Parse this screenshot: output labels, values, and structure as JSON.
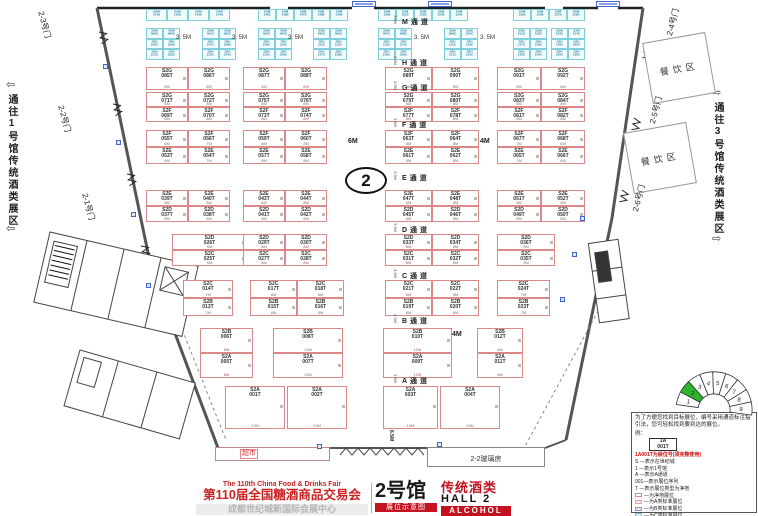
{
  "hall_number": "2",
  "side_labels": {
    "left": "通往1号馆传统酒类展区",
    "right": "通往3号馆传统酒类展区",
    "left_arrow": "⇦",
    "right_arrow": "⇨"
  },
  "areas": {
    "dining1": "餐饮区",
    "dining2": "餐饮区",
    "supermarket": "超市",
    "glasshouse": "2-2玻璃房"
  },
  "gates": [
    {
      "label": "2-3号门",
      "x": 46,
      "y": 10,
      "rot": 75
    },
    {
      "label": "2-2号门",
      "x": 66,
      "y": 104,
      "rot": 75
    },
    {
      "label": "2-1号门",
      "x": 90,
      "y": 192,
      "rot": 75
    },
    {
      "label": "2-4号门",
      "x": 664,
      "y": 34,
      "rot": -75
    },
    {
      "label": "2-5号门",
      "x": 647,
      "y": 122,
      "rot": -75
    },
    {
      "label": "2-6号门",
      "x": 630,
      "y": 210,
      "rot": -75
    }
  ],
  "aisles": {
    "width_marker": "3.5M",
    "items": [
      {
        "label": "M通道",
        "y": 17
      },
      {
        "label": "H通道",
        "y": 58
      },
      {
        "label": "G通道",
        "y": 83
      },
      {
        "label": "F通道",
        "y": 120
      },
      {
        "label": "E通道",
        "y": 173
      },
      {
        "label": "D通道",
        "y": 225
      },
      {
        "label": "C通道",
        "y": 271
      },
      {
        "label": "B通道",
        "y": 316
      },
      {
        "label": "A通道",
        "y": 376
      }
    ]
  },
  "gap_labels": {
    "text": "3. 5M",
    "positions": [
      [
        176,
        35
      ],
      [
        232,
        35
      ],
      [
        288,
        35
      ],
      [
        414,
        35
      ],
      [
        480,
        35
      ]
    ]
  },
  "misc_labels": [
    {
      "text": "6M",
      "x": 348,
      "y": 138,
      "rot": 0
    },
    {
      "text": "4M",
      "x": 480,
      "y": 138,
      "rot": 0
    },
    {
      "text": "4M",
      "x": 452,
      "y": 331,
      "rot": 0
    },
    {
      "text": "6.5M",
      "x": 394,
      "y": 430,
      "rot": 90
    }
  ],
  "fire_squares": [
    [
      103,
      64
    ],
    [
      116,
      140
    ],
    [
      131,
      212
    ],
    [
      146,
      283
    ],
    [
      580,
      216
    ],
    [
      572,
      252
    ],
    [
      560,
      297
    ],
    [
      437,
      442
    ],
    [
      317,
      444
    ]
  ],
  "blue_tags": [
    [
      352,
      1
    ],
    [
      428,
      1
    ],
    [
      596,
      1
    ]
  ],
  "booths": {
    "standard": [
      [
        146,
        67,
        42,
        23,
        "S2G",
        "085T",
        "8M"
      ],
      [
        188,
        67,
        42,
        23,
        "S2G",
        "086T",
        "8M"
      ],
      [
        243,
        67,
        42,
        23,
        "S2G",
        "087T",
        "8M"
      ],
      [
        285,
        67,
        42,
        23,
        "S2G",
        "088T",
        "8M"
      ],
      [
        385,
        67,
        47,
        23,
        "S2G",
        "089T",
        "8M"
      ],
      [
        432,
        67,
        47,
        23,
        "S2G",
        "090T",
        "8M"
      ],
      [
        497,
        67,
        44,
        23,
        "S2G",
        "091T",
        "8M"
      ],
      [
        541,
        67,
        44,
        23,
        "S2G",
        "092T",
        "8M"
      ],
      [
        146,
        92,
        42,
        15,
        "S2G",
        "071T",
        "8M"
      ],
      [
        188,
        92,
        42,
        15,
        "S2G",
        "072T",
        "8M"
      ],
      [
        243,
        92,
        42,
        15,
        "S2G",
        "075T",
        "8M"
      ],
      [
        285,
        92,
        42,
        15,
        "S2G",
        "076T",
        "8M"
      ],
      [
        385,
        92,
        47,
        15,
        "S2G",
        "079T",
        "8M"
      ],
      [
        432,
        92,
        47,
        15,
        "S2G",
        "080T",
        "8M"
      ],
      [
        497,
        92,
        44,
        15,
        "S2G",
        "083T",
        "8M"
      ],
      [
        541,
        92,
        44,
        15,
        "S2G",
        "084T",
        "8M"
      ],
      [
        146,
        107,
        42,
        15,
        "S2F",
        "069T",
        "8M"
      ],
      [
        188,
        107,
        42,
        15,
        "S2F",
        "070T",
        "8M"
      ],
      [
        243,
        107,
        42,
        15,
        "S2F",
        "073T",
        "8M"
      ],
      [
        285,
        107,
        42,
        15,
        "S2F",
        "074T",
        "8M"
      ],
      [
        385,
        107,
        47,
        15,
        "S2F",
        "077T",
        "8M"
      ],
      [
        432,
        107,
        47,
        15,
        "S2F",
        "078T",
        "8M"
      ],
      [
        497,
        107,
        44,
        15,
        "S2F",
        "081T",
        "8M"
      ],
      [
        541,
        107,
        44,
        15,
        "S2F",
        "082T",
        "8M"
      ],
      [
        146,
        130,
        42,
        17,
        "S2F",
        "055T",
        "6M"
      ],
      [
        188,
        130,
        42,
        17,
        "S2F",
        "056T",
        "7M"
      ],
      [
        243,
        130,
        42,
        17,
        "S2F",
        "059T",
        "8M"
      ],
      [
        285,
        130,
        42,
        17,
        "S2F",
        "060T",
        "8M"
      ],
      [
        385,
        130,
        47,
        17,
        "S2F",
        "063T",
        "8M"
      ],
      [
        432,
        130,
        47,
        17,
        "S2F",
        "064T",
        "8M"
      ],
      [
        497,
        130,
        44,
        17,
        "S2F",
        "067T",
        "7M"
      ],
      [
        541,
        130,
        44,
        17,
        "S2F",
        "068T",
        "6M"
      ],
      [
        146,
        147,
        42,
        17,
        "S2E",
        "053T",
        "6M"
      ],
      [
        188,
        147,
        42,
        17,
        "S2E",
        "054T",
        "7M"
      ],
      [
        243,
        147,
        42,
        17,
        "S2E",
        "057T",
        "8M"
      ],
      [
        285,
        147,
        42,
        17,
        "S2E",
        "058T",
        "8M"
      ],
      [
        385,
        147,
        47,
        17,
        "S2E",
        "061T",
        "8M"
      ],
      [
        432,
        147,
        47,
        17,
        "S2E",
        "062T",
        "8M"
      ],
      [
        497,
        147,
        44,
        17,
        "S2E",
        "065T",
        "7M"
      ],
      [
        541,
        147,
        44,
        17,
        "S2E",
        "066T",
        "6M"
      ],
      [
        146,
        190,
        42,
        16,
        "S2E",
        "039T",
        "8M"
      ],
      [
        188,
        190,
        42,
        16,
        "S2E",
        "040T",
        "8M"
      ],
      [
        243,
        190,
        42,
        16,
        "S2E",
        "043T",
        "8M"
      ],
      [
        285,
        190,
        42,
        16,
        "S2E",
        "044T",
        "8M"
      ],
      [
        385,
        190,
        47,
        16,
        "S2E",
        "047T",
        "8M"
      ],
      [
        432,
        190,
        47,
        16,
        "S2E",
        "048T",
        "8M"
      ],
      [
        497,
        190,
        44,
        16,
        "S2E",
        "051T",
        "8M"
      ],
      [
        541,
        190,
        44,
        16,
        "S2E",
        "052T",
        "8M"
      ],
      [
        146,
        206,
        42,
        16,
        "S2D",
        "037T",
        "8M"
      ],
      [
        188,
        206,
        42,
        16,
        "S2D",
        "038T",
        "8M"
      ],
      [
        243,
        206,
        42,
        16,
        "S2D",
        "041T",
        "8M"
      ],
      [
        285,
        206,
        42,
        16,
        "S2D",
        "042T",
        "8M"
      ],
      [
        385,
        206,
        47,
        16,
        "S2D",
        "045T",
        "8M"
      ],
      [
        432,
        206,
        47,
        16,
        "S2D",
        "046T",
        "8M"
      ],
      [
        497,
        206,
        44,
        16,
        "S2D",
        "049T",
        "8M"
      ],
      [
        541,
        206,
        44,
        16,
        "S2D",
        "050T",
        "8M"
      ],
      [
        172,
        234,
        75,
        16,
        "S2D",
        "026T",
        "9M"
      ],
      [
        243,
        234,
        42,
        16,
        "S2D",
        "029T",
        "8M"
      ],
      [
        285,
        234,
        42,
        16,
        "S2D",
        "030T",
        "8M"
      ],
      [
        385,
        234,
        47,
        16,
        "S2D",
        "033T",
        "8M"
      ],
      [
        432,
        234,
        47,
        16,
        "S2D",
        "034T",
        "8M"
      ],
      [
        497,
        234,
        58,
        16,
        "S2D",
        "036T",
        "9M"
      ],
      [
        172,
        250,
        75,
        16,
        "S2C",
        "025T",
        "9M"
      ],
      [
        243,
        250,
        42,
        16,
        "S2C",
        "027T",
        "8M"
      ],
      [
        285,
        250,
        42,
        16,
        "S2C",
        "028T",
        "8M"
      ],
      [
        385,
        250,
        47,
        16,
        "S2C",
        "031T",
        "8M"
      ],
      [
        432,
        250,
        47,
        16,
        "S2C",
        "032T",
        "8M"
      ],
      [
        497,
        250,
        58,
        16,
        "S2C",
        "035T",
        "9M"
      ],
      [
        183,
        280,
        50,
        18,
        "S2C",
        "014T",
        "7M"
      ],
      [
        250,
        280,
        47,
        18,
        "S2C",
        "017T",
        "8M"
      ],
      [
        297,
        280,
        47,
        18,
        "S2C",
        "018T",
        "8M"
      ],
      [
        385,
        280,
        47,
        18,
        "S2C",
        "021T",
        "8M"
      ],
      [
        432,
        280,
        47,
        18,
        "S2C",
        "022T",
        "8M"
      ],
      [
        497,
        280,
        53,
        18,
        "S2C",
        "024T",
        "7M"
      ],
      [
        183,
        298,
        50,
        18,
        "S2B",
        "013T",
        "7M"
      ],
      [
        250,
        298,
        47,
        18,
        "S2B",
        "015T",
        "8M"
      ],
      [
        297,
        298,
        47,
        18,
        "S2B",
        "016T",
        "8M"
      ],
      [
        385,
        298,
        47,
        18,
        "S2B",
        "019T",
        "8M"
      ],
      [
        432,
        298,
        47,
        18,
        "S2B",
        "020T",
        "8M"
      ],
      [
        497,
        298,
        53,
        18,
        "S2B",
        "023T",
        "7M"
      ],
      [
        200,
        328,
        53,
        25,
        "S2B",
        "006T",
        "8M"
      ],
      [
        273,
        328,
        70,
        25,
        "S2B",
        "008T",
        "12M"
      ],
      [
        383,
        328,
        69,
        25,
        "S2B",
        "010T",
        "12M"
      ],
      [
        477,
        328,
        46,
        25,
        "S2B",
        "012T",
        "8M"
      ],
      [
        200,
        353,
        53,
        25,
        "S2A",
        "005T",
        "8M"
      ],
      [
        273,
        353,
        70,
        25,
        "S2A",
        "007T",
        "12M"
      ],
      [
        383,
        353,
        69,
        25,
        "S2A",
        "009T",
        "12M"
      ],
      [
        477,
        353,
        46,
        25,
        "S2A",
        "011T",
        "8M"
      ],
      [
        225,
        386,
        60,
        43,
        "S2A",
        "001T",
        "10M"
      ],
      [
        287,
        386,
        60,
        43,
        "S2A",
        "002T",
        "10M"
      ],
      [
        383,
        386,
        55,
        43,
        "S2A",
        "003T",
        "10M"
      ],
      [
        440,
        386,
        60,
        43,
        "S2A",
        "004T",
        "10M"
      ]
    ],
    "small_row": [
      {
        "x": 146,
        "w": 21,
        "pre": "S2M",
        "nums": [
          "141S",
          "142S",
          "143S",
          "144S"
        ]
      },
      {
        "x": 258,
        "w": 18,
        "pre": "S2M",
        "nums": [
          "145S",
          "146S",
          "147S",
          "148S",
          "149S"
        ]
      },
      {
        "x": 378,
        "w": 18,
        "pre": "S2M",
        "nums": [
          "150S",
          "151S",
          "152S",
          "153S",
          "154S"
        ]
      },
      {
        "x": 513,
        "w": 18,
        "pre": "S2M",
        "nums": [
          "155S",
          "156S",
          "157S",
          "158S"
        ]
      }
    ],
    "small_clusters": [
      {
        "x": 146,
        "rows": [
          [
            "S2M",
            "089C",
            "090C"
          ],
          [
            "S2H",
            "105C",
            "106C"
          ],
          [
            "S2H",
            "121C",
            "122C"
          ]
        ]
      },
      {
        "x": 202,
        "rows": [
          [
            "S2M",
            "091C",
            "092C"
          ],
          [
            "S2H",
            "107C",
            "108C"
          ],
          [
            "S2H",
            "123C",
            "124C"
          ]
        ]
      },
      {
        "x": 258,
        "rows": [
          [
            "S2M",
            "093C",
            "094C"
          ],
          [
            "S2H",
            "109C",
            "110C"
          ],
          [
            "S2H",
            "125C",
            "126C"
          ]
        ]
      },
      {
        "x": 313,
        "rows": [
          [
            "S2M",
            "095C",
            "096C"
          ],
          [
            "S2H",
            "111C",
            "112C"
          ],
          [
            "S2H",
            "127C",
            "128C"
          ]
        ]
      },
      {
        "x": 378,
        "rows": [
          [
            "S2M",
            "097C",
            "098C"
          ],
          [
            "S2H",
            "113C",
            "114C"
          ],
          [
            "S2H",
            "129C",
            "130C"
          ]
        ]
      },
      {
        "x": 444,
        "rows": [
          [
            "S2M",
            "099C",
            "100C"
          ],
          [
            "S2H",
            "115C",
            "116C"
          ],
          [
            "S2H",
            "131C",
            "132C"
          ]
        ]
      },
      {
        "x": 513,
        "rows": [
          [
            "S2M",
            "101C",
            "102C"
          ],
          [
            "S2H",
            "117C",
            "118C"
          ],
          [
            "S2H",
            "133C",
            "134C"
          ]
        ]
      },
      {
        "x": 551,
        "rows": [
          [
            "S2M",
            "103C",
            "104C"
          ],
          [
            "S2H",
            "119C",
            "120C"
          ],
          [
            "S2H",
            "135C",
            "136C"
          ]
        ]
      }
    ]
  },
  "banner": {
    "en": "The 110th China Food & Drinks Fair",
    "cn": "第110届全国糖酒商品交易会",
    "venue": "成都世纪城新国际会展中心",
    "hall_cn": "2号馆",
    "badge": "展位示意图",
    "cat": "传统酒类",
    "hall_en": "HALL 2",
    "alcohol": "ALCOHOL"
  },
  "legend": {
    "intro": "为了方便您找到目标展位，编号采用通道标注指引法，您可轻松找到要到达的展位。",
    "example": "例：",
    "sample_top": "1A",
    "sample_bottom": "001T",
    "red_note": "1A001T为展位号(须完整使用)",
    "decode": [
      "S —表示在世纪城",
      "1 —表示1号馆",
      "A —表示A通道",
      "001—表示展位序列",
      "T —表示展位类型为净地"
    ],
    "types": [
      {
        "border": "#dd8888",
        "fill": "#ffffff",
        "label": "—为净地展位"
      },
      {
        "border": "#e8a0c0",
        "fill": "#fde8f0",
        "label": "—为A类标准展位"
      },
      {
        "border": "#9090d8",
        "fill": "#e8e8fa",
        "label": "—为B类标准展位"
      },
      {
        "border": "#70c8d8",
        "fill": "#d8f2f8",
        "label": "—为C类标准展位"
      },
      {
        "border": "#80b0e0",
        "fill": "#e6f0fa",
        "label": "—为D类标准展位"
      }
    ],
    "fire_note": "消防设施严禁遮挡"
  },
  "compass": {
    "segments": [
      "1",
      "2",
      "3",
      "4",
      "5",
      "6",
      "7",
      "8",
      "9"
    ],
    "highlight_index": 1,
    "highlight_color": "#2db52d"
  }
}
